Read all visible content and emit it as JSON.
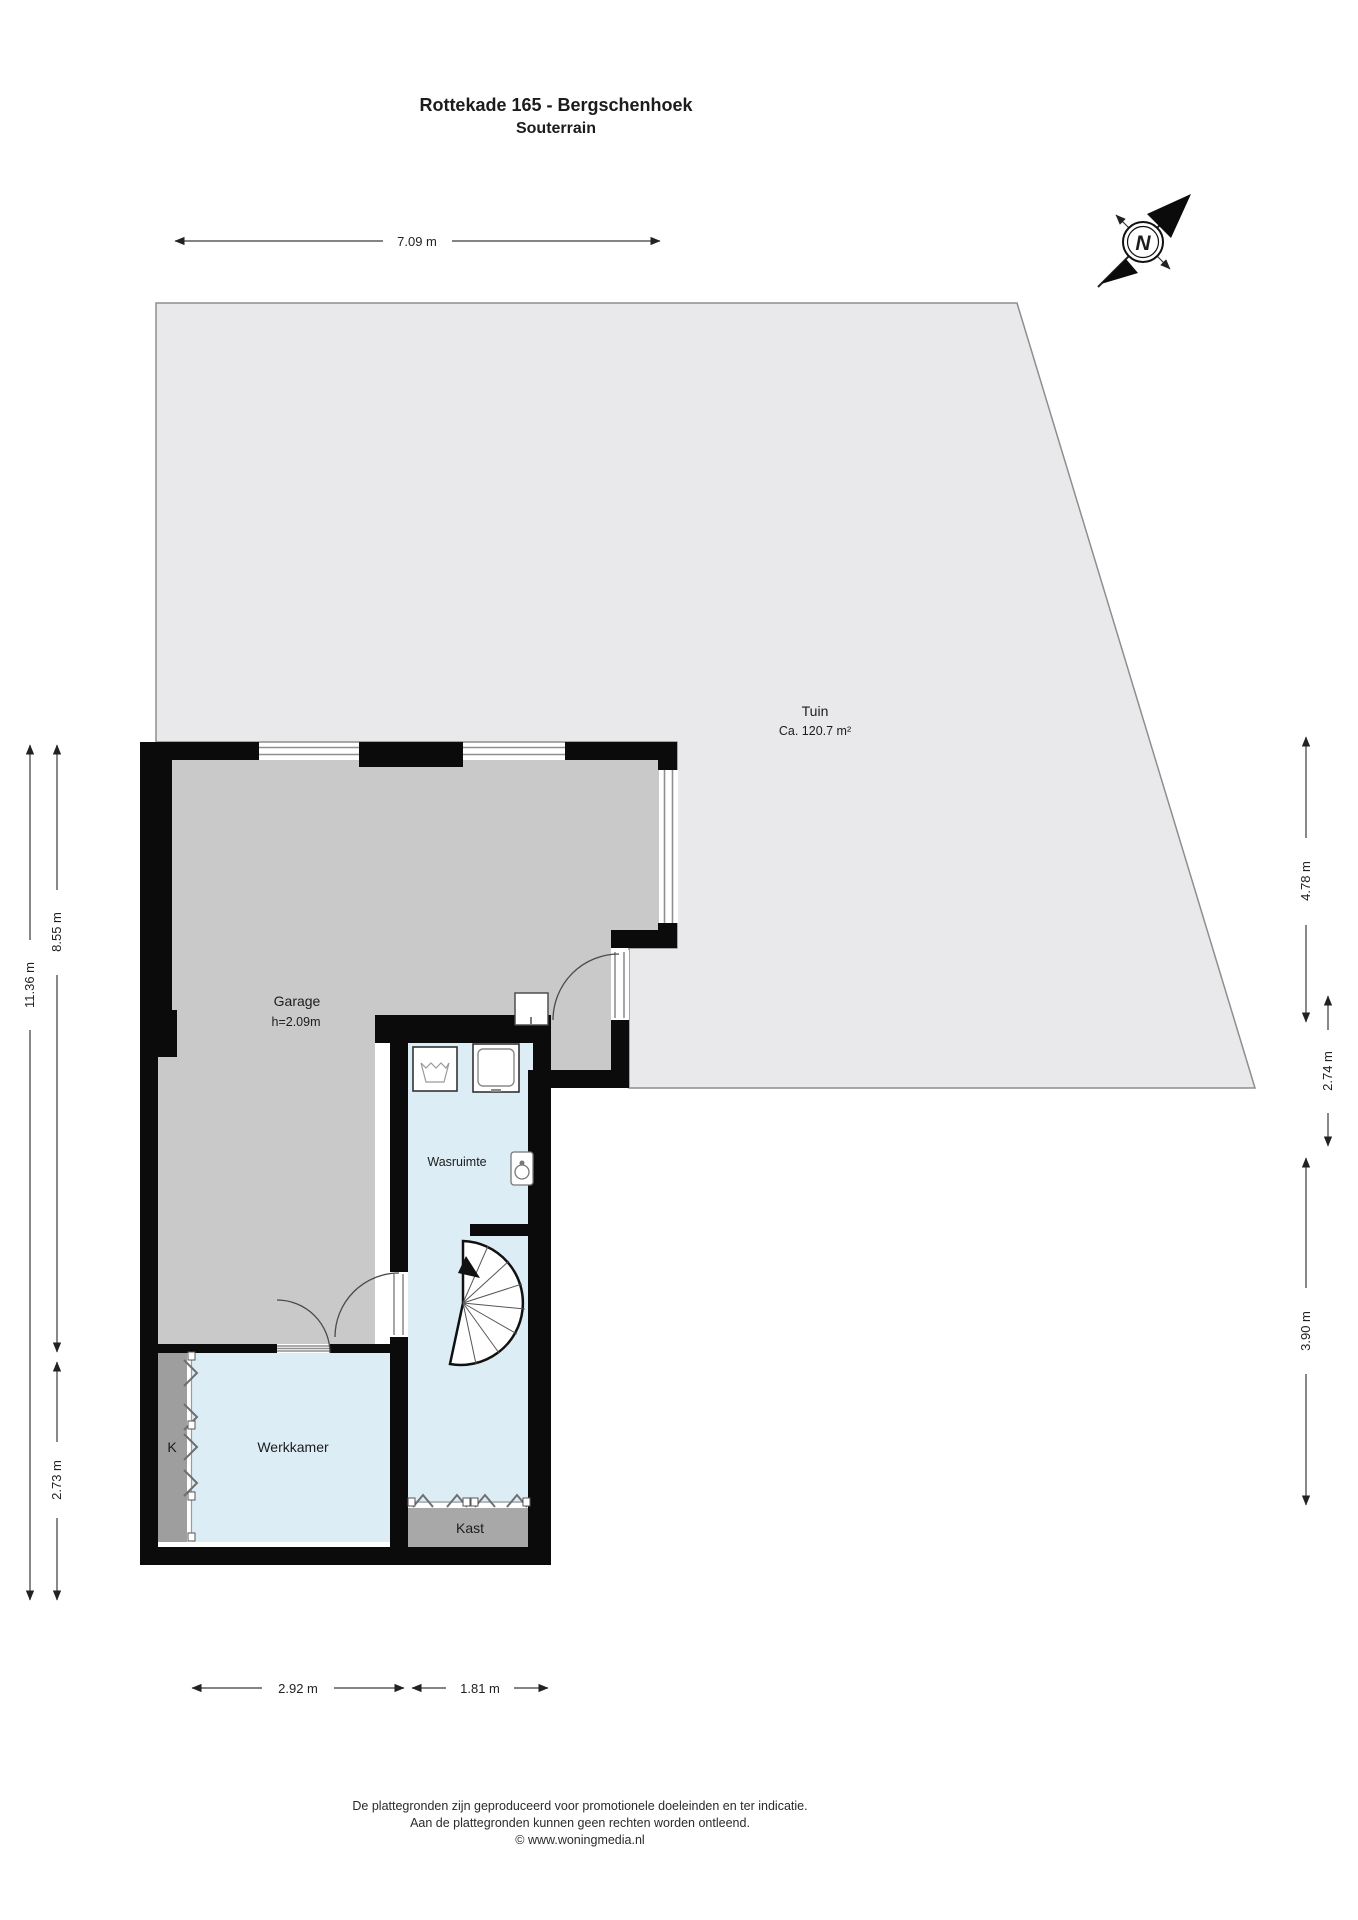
{
  "title": {
    "line1": "Rottekade 165 - Bergschenhoek",
    "line2": "Souterrain"
  },
  "compass": {
    "north_label": "N"
  },
  "rooms": {
    "tuin": {
      "name": "Tuin",
      "area": "Ca. 120.7 m²"
    },
    "garage": {
      "name": "Garage",
      "ceiling_height": "h=2.09m"
    },
    "wasruimte": {
      "name": "Wasruimte"
    },
    "werkkamer": {
      "name": "Werkkamer"
    },
    "kast": {
      "name": "Kast"
    },
    "kast_k": {
      "name": "K"
    }
  },
  "dimensions": {
    "top_width": "7.09 m",
    "left_total_height": "11.36 m",
    "left_upper_height": "8.55 m",
    "left_lower_height": "2.73 m",
    "right_upper_height": "4.78 m",
    "right_middle_height": "2.74 m",
    "right_lower_height": "3.90 m",
    "bottom_left_width": "2.92 m",
    "bottom_right_width": "1.81 m"
  },
  "footer": {
    "line1": "De plattegronden zijn geproduceerd voor promotionele doeleinden en ter indicatie.",
    "line2": "Aan de plattegronden kunnen geen rechten worden ontleend.",
    "line3": "© www.woningmedia.nl"
  },
  "colors": {
    "garden": "#e9e9eb",
    "garage_floor": "#c9c9c9",
    "room_floor": "#ddedf6",
    "closet_fill": "#9e9e9e",
    "kast_fill": "#a8a8a8",
    "wall": "#0b0b0b"
  }
}
